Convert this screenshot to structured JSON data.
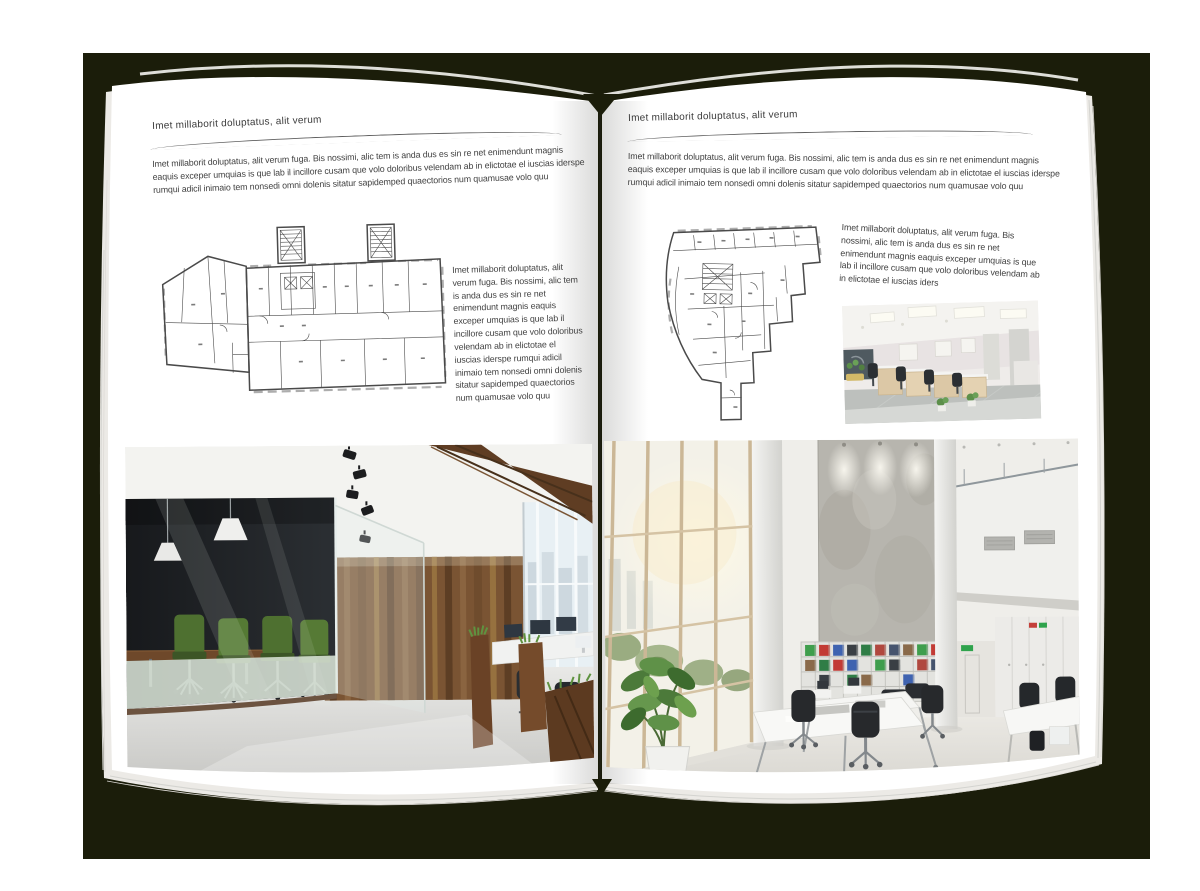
{
  "colors": {
    "backdrop": "#1b1d0a",
    "page": "#ffffff",
    "text": "#414141",
    "rule": "#5f5f5f"
  },
  "page_left": {
    "header": "Imet millaborit doluptatus, alit verum",
    "intro": "Imet millaborit doluptatus, alit verum fuga. Bis nossimi, alic tem is anda dus es sin re net enimendunt magnis eaquis exceper umquias is que lab il incillore cusam que volo doloribus velendam ab in elictotae el iuscias iderspe rumqui adicil inimaio tem nonsedi omni dolenis sitatur sapidemped quaectorios num quamusae volo quu",
    "side_text": "Imet millaborit doluptatus, alit verum fuga. Bis nossimi, alic tem is anda dus es sin re net enimendunt magnis eaquis exceper umquias is que lab il incillore cusam que volo doloribus velendam ab in elictotae el iuscias iderspe rumqui adicil inimaio tem nonsedi omni dolenis sitatur sapidemped quaectorios num quamusae volo quu"
  },
  "page_right": {
    "header": "Imet millaborit doluptatus, alit verum",
    "intro": "Imet millaborit doluptatus, alit verum fuga. Bis nossimi, alic tem is anda dus es sin re net enimendunt magnis eaquis exceper umquias is que lab il incillore cusam que volo doloribus velendam ab in elictotae el iuscias iderspe rumqui adicil inimaio tem nonsedi omni dolenis sitatur sapidemped quaectorios num quamusae volo quu",
    "side_text": "Imet millaborit doluptatus, alit verum fuga. Bis nossimi, alic tem is anda dus es sin re net enimendunt magnis eaquis exceper umquias is que lab il incillore cusam que volo doloribus velendam ab in elictotae el iuscias iders"
  }
}
